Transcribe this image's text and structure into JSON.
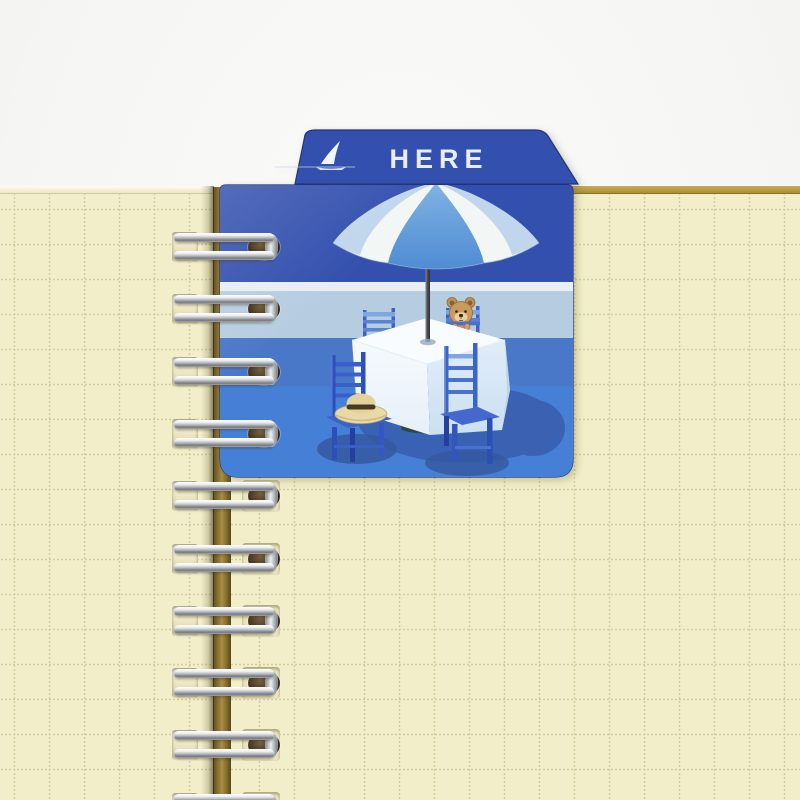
{
  "image": {
    "type": "product-photo",
    "description": "Open spiral wire-bound notebook with cream grid paper; a blue plastic index-tab bookmark card is bound into the wire rings. The tab reads HERE and the card shows a seaside cafe illustration: white-and-blue beach umbrella over a table with a white cloth, four blue chairs, a straw hat on the near chair seat and a small teddy bear seated across the table, with a tiny sailboat on the horizon.",
    "background_color": "#f6f6f4"
  },
  "bookmark": {
    "tab_label": "HERE",
    "card_color": "#3350ae",
    "edge_color": "#233579",
    "illustration": {
      "elements": [
        "sailboat",
        "beach-umbrella",
        "umbrella-pole",
        "table-with-white-cloth",
        "blue-cafe-chairs",
        "straw-hat",
        "teddy-bear",
        "floor-shadow"
      ],
      "chair_count": 4,
      "band_colors_top_to_bottom": [
        "#3350ae",
        "#e9eef4",
        "#b6cde1",
        "#4a78c8",
        "#457fd6"
      ],
      "umbrella_panel_colors": [
        "#f2f6f4",
        "#5b96d8",
        "#b7d0ea"
      ],
      "shadow_color": "#3a61b2",
      "bear_color": "#c99a5e",
      "hat_color": "#e9d9a6"
    }
  },
  "notebook": {
    "paper_color": "#f2eec9",
    "grid_color": "#d5cc9e",
    "grid_spacing_px": 35,
    "page_edge_color": "#c8ad52",
    "spine_color": "#937b35",
    "binding": {
      "type": "double-loop-wire",
      "ring_count": 10,
      "wire_color": "#c9cdd1",
      "ring_opening_color": "#463520"
    }
  }
}
